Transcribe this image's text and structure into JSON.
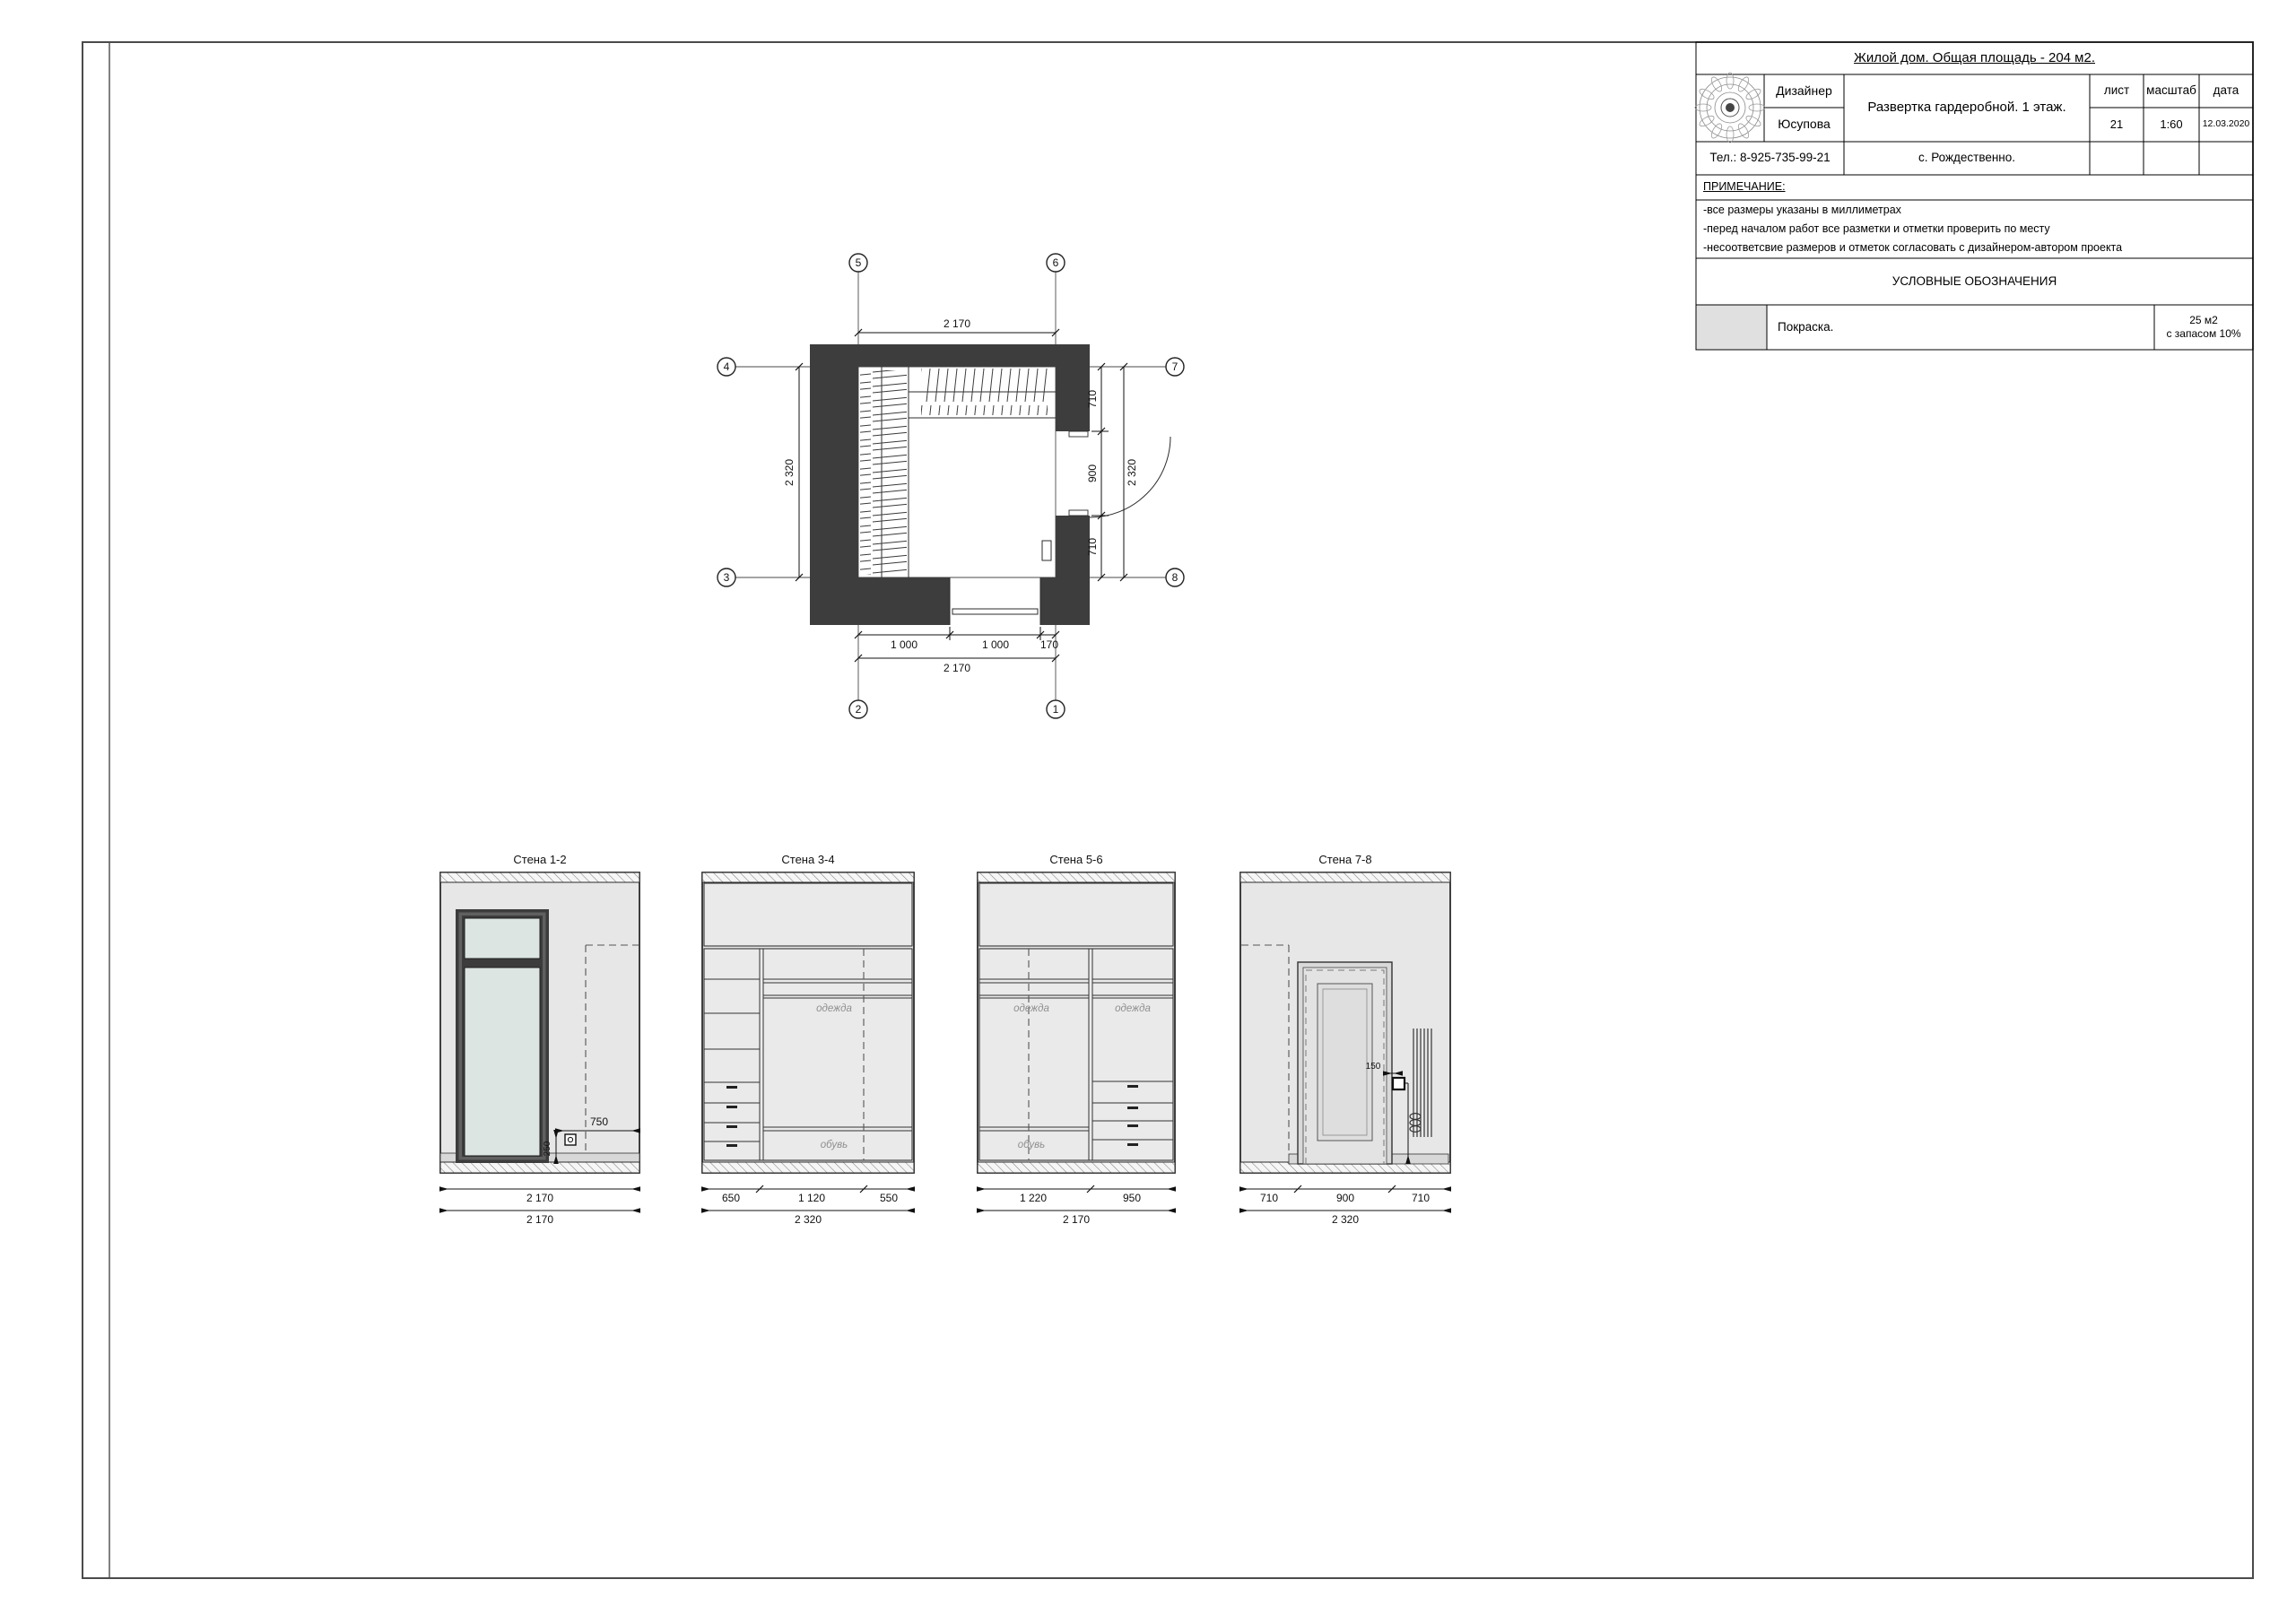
{
  "title_block": {
    "project": "Жилой дом. Общая площадь - 204 м2.",
    "designer_label": "Дизайнер",
    "designer_name": "Юсупова",
    "drawing_title": "Развертка гардеробной. 1 этаж.",
    "sheet_label": "лист",
    "sheet_number": "21",
    "scale_label": "масштаб",
    "scale_value": "1:60",
    "date_label": "дата",
    "date_value": "12.03.2020",
    "phone": "Тел.: 8-925-735-99-21",
    "location": "с. Рождественно.",
    "note_heading": "ПРИМЕЧАНИЕ:",
    "notes": [
      "-все размеры указаны в миллиметрах",
      "-перед началом работ все разметки и отметки проверить по месту",
      "-несоответсвие размеров и отметок согласовать с дизайнером-автором проекта"
    ],
    "legend_heading": "УСЛОВНЫЕ ОБОЗНАЧЕНИЯ",
    "legend_item": "Покраска.",
    "legend_qty_line1": "25 м2",
    "legend_qty_line2": "с запасом 10%"
  },
  "plan": {
    "axes": {
      "a1": "1",
      "a2": "2",
      "a3": "3",
      "a4": "4",
      "a5": "5",
      "a6": "6",
      "a7": "7",
      "a8": "8"
    },
    "dim_top": "2 170",
    "dim_left": "2 320",
    "dim_right_1": "710",
    "dim_right_2": "900",
    "dim_right_3": "710",
    "dim_right_total": "2 320",
    "dim_bottom_1": "1 000",
    "dim_bottom_2": "1 000",
    "dim_bottom_3": "170",
    "dim_bottom_total": "2 170"
  },
  "elev1": {
    "title": "Стена 1-2",
    "dim_socket_h": "750",
    "dim_socket_v": "250",
    "dim_width": "2 170",
    "dim_total": "2 170"
  },
  "elev2": {
    "title": "Стена 3-4",
    "label_clothes": "одежда",
    "label_shoes": "обувь",
    "dim_1": "650",
    "dim_2": "1 120",
    "dim_3": "550",
    "dim_total": "2 320"
  },
  "elev3": {
    "title": "Стена 5-6",
    "label_clothes_left": "одежда",
    "label_clothes_right": "одежда",
    "label_shoes": "обувь",
    "dim_1": "1 220",
    "dim_2": "950",
    "dim_total": "2 170"
  },
  "elev4": {
    "title": "Стена 7-8",
    "dim_switch": "150",
    "dim_1": "710",
    "dim_2": "900",
    "dim_3": "710",
    "dim_total": "2 320"
  },
  "colors": {
    "wall_dark": "#3d3d3d",
    "elevation_wall": "#e7e7e7",
    "glass": "#dce5e2",
    "legend_swatch": "#e0e0e0",
    "label_gray": "#8f8f8f"
  }
}
